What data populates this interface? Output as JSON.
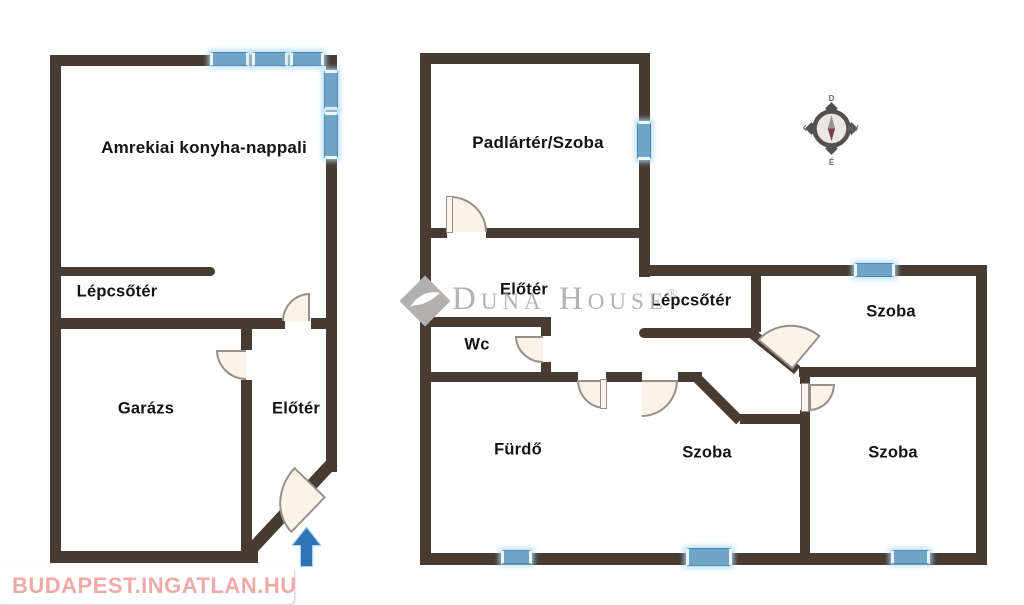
{
  "document": {
    "type": "floor-plan",
    "language": "Hungarian",
    "background_color": "#ffffff"
  },
  "colors": {
    "wall": "#473B32",
    "window_fill": "#6FA5C6",
    "window_border": "#4D89AC",
    "window_glow": "#AAD8F0",
    "door_fill": "#FAF3E7",
    "door_border": "#97908A",
    "label_text": "#141414",
    "entrance_arrow_fill": "#2E74B5",
    "entrance_arrow_outline": "#A9D7F2",
    "watermark_gray": "#B5B3B1",
    "watermark_pink": "#EFAAA8",
    "compass_ring": "#55504B",
    "compass_face": "#EAE8E5",
    "compass_needle_north": "#7E3B44",
    "compass_needle_south": "#9A9691"
  },
  "floorplans": [
    {
      "name": "ground-floor-plan",
      "rooms": [
        {
          "label": "Amrekiai konyha-nappali"
        },
        {
          "label": "Lépcsőtér"
        },
        {
          "label": "Garázs"
        },
        {
          "label": "Előtér"
        }
      ],
      "entrance_arrow_direction": "up"
    },
    {
      "name": "upper-floor-plan",
      "rooms": [
        {
          "label": "Padlártér/Szoba"
        },
        {
          "label": "Előtér"
        },
        {
          "label": "Lépcsőtér"
        },
        {
          "label": "Wc"
        },
        {
          "label": "Fürdő"
        },
        {
          "label": "Szoba"
        },
        {
          "label": "Szoba"
        },
        {
          "label": "Szoba"
        }
      ]
    }
  ],
  "compass": {
    "top": "D",
    "right": "NY",
    "bottom": "É",
    "left": "K"
  },
  "watermarks": {
    "duna_house": {
      "text": "Duna House",
      "registered": "®"
    },
    "ingatlan": {
      "text": "BUDAPEST.INGATLAN.HU"
    }
  },
  "icons": [
    "compass-rose-icon",
    "duna-house-diamond-icon",
    "ingatlan-house-icon",
    "entrance-arrow-icon"
  ]
}
